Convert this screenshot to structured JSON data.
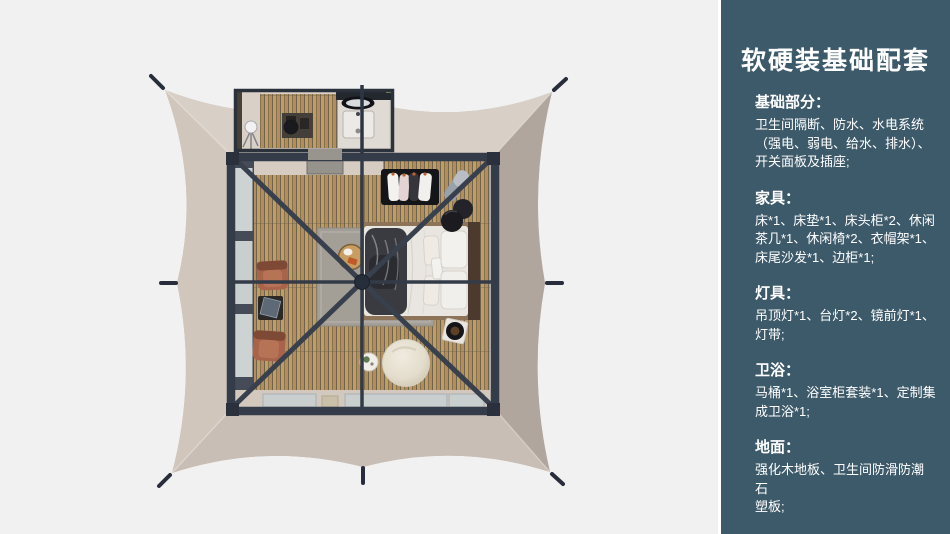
{
  "sidebar": {
    "title": "软硬装基础配套",
    "sections": [
      {
        "heading": "基础部分：",
        "body": "卫生间隔断、防水、水电系统\n（强电、弱电、给水、排水）、\n开关面板及插座;"
      },
      {
        "heading": "家具：",
        "body": "床*1、床垫*1、床头柜*2、休闲\n茶几*1、休闲椅*2、衣帽架*1、\n床尾沙发*1、边柜*1;"
      },
      {
        "heading": "灯具：",
        "body": "吊顶灯*1、台灯*2、镜前灯*1、\n灯带;"
      },
      {
        "heading": "卫浴：",
        "body": "马桶*1、浴室柜套装*1、定制集\n成卫浴*1;"
      },
      {
        "heading": "地面：",
        "body": "强化木地板、卫生间防滑防潮石\n塑板;"
      }
    ]
  },
  "colors": {
    "panel_bg": "#3d5a6a",
    "canvas_base": "#c6bbb2",
    "frame_dark": "#343c49",
    "wood_plank": "#c09d63",
    "terracotta": "#a9634a"
  }
}
